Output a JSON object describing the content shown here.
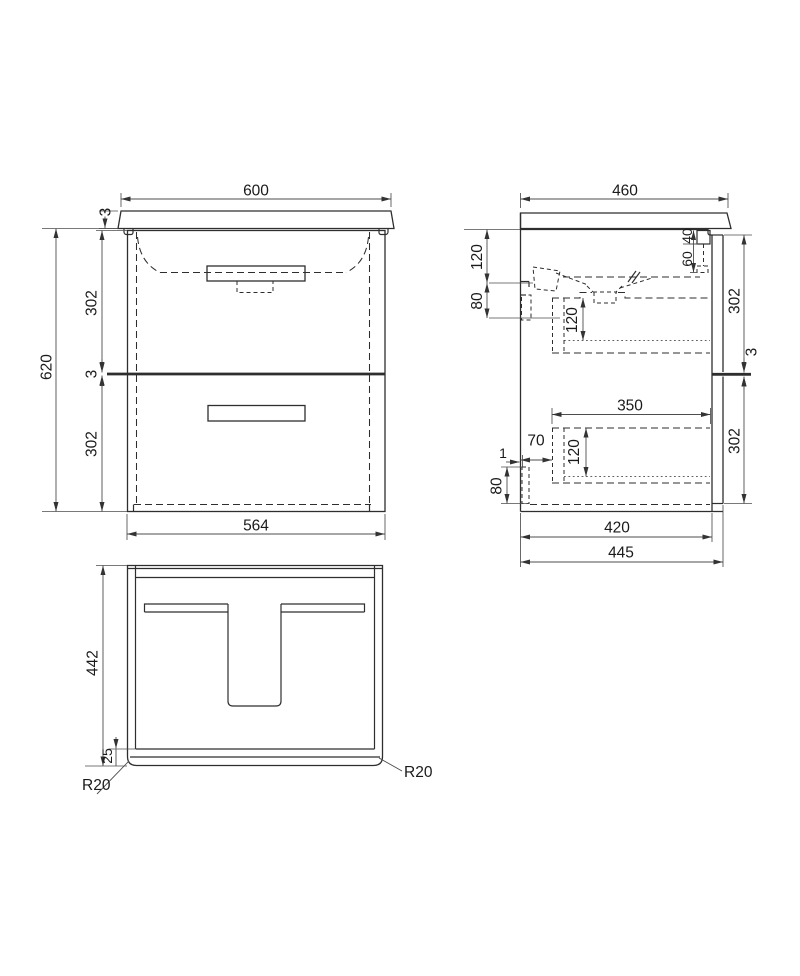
{
  "drawing_title": "Vanity unit 600 technical drawing",
  "front": {
    "width_top": "600",
    "counter_gap": "3",
    "height": "620",
    "upper_drawer": "302",
    "mid_gap": "3",
    "lower_drawer": "302",
    "width_body": "564"
  },
  "side": {
    "depth_top": "460",
    "tap_above": "120",
    "tap_below": "80",
    "bracket_w": "40",
    "bracket_h": "60",
    "upper_front": "302",
    "mid_gap": "3",
    "lower_front": "302",
    "drawer_depth": "350",
    "upper_box_h": "120",
    "lower_box_h": "120",
    "back_offset": "70",
    "back_gap": "1",
    "back_panel_h": "80",
    "depth_internal": "420",
    "depth_overall": "445"
  },
  "plan": {
    "depth": "442",
    "front_edge": "25",
    "radius_left": "R20",
    "radius_right": "R20"
  }
}
